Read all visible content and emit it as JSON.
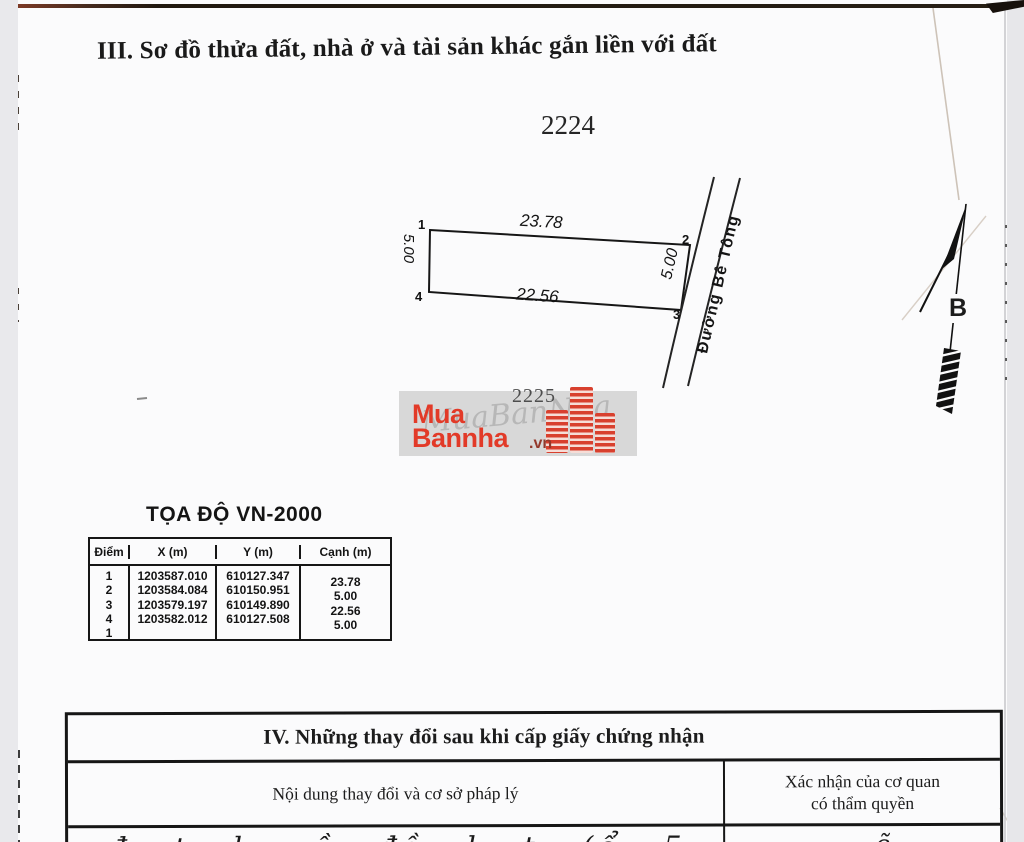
{
  "page": {
    "section3_title": "III. Sơ đồ thửa đất, nhà ở và tài sản khác gắn liền với đất",
    "plot_number_top": "2224",
    "plot_number_mid": "2225"
  },
  "diagram": {
    "corner_labels": [
      "1",
      "2",
      "3",
      "4"
    ],
    "edge_top": "23.78",
    "edge_bottom": "22.56",
    "edge_left": "5.00",
    "edge_right": "5.00",
    "road_label": "Đường Bê Tông",
    "north_label": "B"
  },
  "watermark": {
    "word1": "Mua",
    "word2": "Bannha",
    "domain_suffix": ".vn",
    "ghost_text": "MuaBanNha",
    "brand_red": "#e23a28"
  },
  "coord_table": {
    "title": "TỌA ĐỘ VN-2000",
    "col_point": "Điểm",
    "col_x": "X (m)",
    "col_y": "Y (m)",
    "col_edge": "Cạnh (m)",
    "points": [
      "1",
      "2",
      "3",
      "4",
      "1"
    ],
    "x_values": [
      "1203587.010",
      "1203584.084",
      "1203579.197",
      "1203582.012"
    ],
    "y_values": [
      "610127.347",
      "610150.951",
      "610149.890",
      "610127.508"
    ],
    "edge_lengths": [
      "23.78",
      "5.00",
      "22.56",
      "5.00"
    ]
  },
  "section4": {
    "title": "IV. Những thay đổi sau khi cấp giấy chứng nhận",
    "left_header": "Nội dung thay đổi và cơ sở pháp lý",
    "right_header_line1": "Xác nhận của cơ quan",
    "right_header_line2": "có thẩm quyền",
    "clipped_left": "đ t l nề đồ l t (ổ 5 l",
    "clipped_right": "ẽ"
  }
}
